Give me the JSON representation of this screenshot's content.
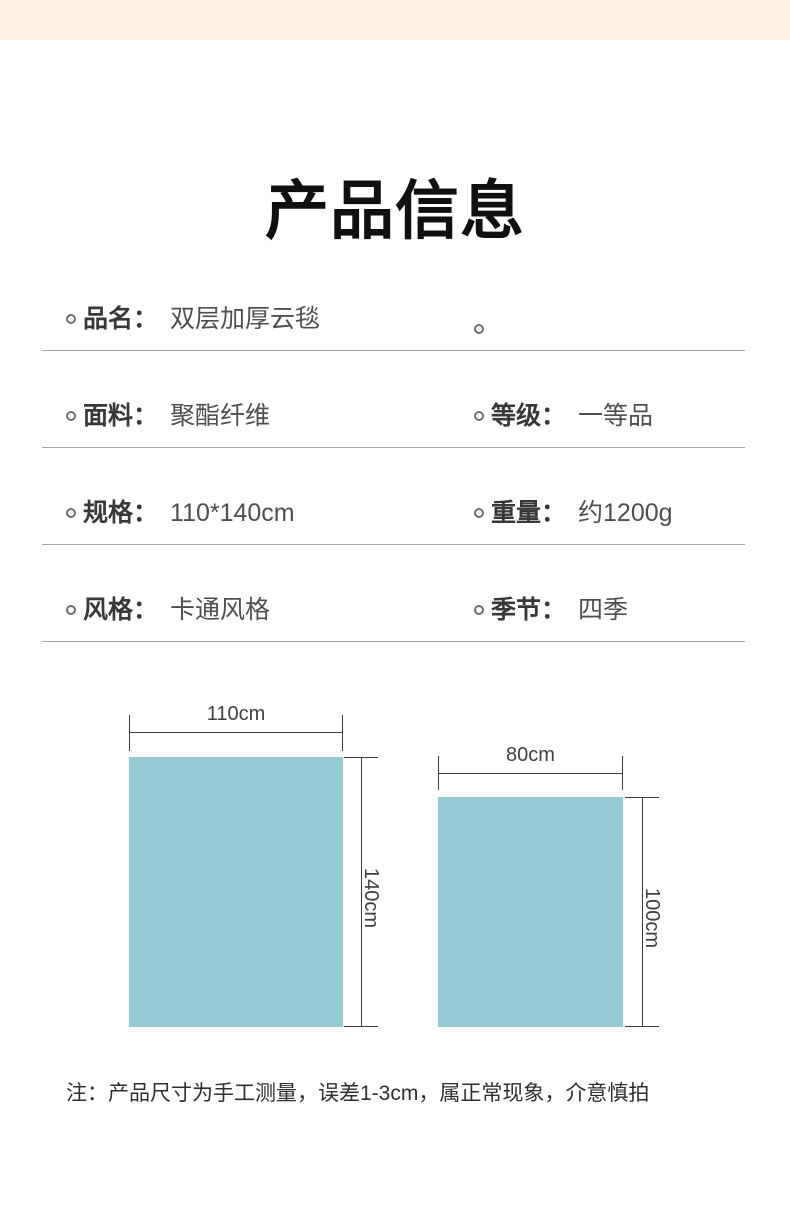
{
  "banner": {
    "color": "#fdf1e4"
  },
  "title": "产品信息",
  "spec_table": {
    "rows": [
      {
        "left": {
          "label": "品名：",
          "value": "双层加厚云毯"
        },
        "right": {
          "label": "",
          "value": ""
        }
      },
      {
        "left": {
          "label": "面料：",
          "value": "聚酯纤维"
        },
        "right": {
          "label": "等级：",
          "value": "一等品"
        }
      },
      {
        "left": {
          "label": "规格：",
          "value": "110*140cm"
        },
        "right": {
          "label": "重量：",
          "value": "约1200g"
        }
      },
      {
        "left": {
          "label": "风格：",
          "value": "卡通风格"
        },
        "right": {
          "label": "季节：",
          "value": "四季"
        }
      }
    ]
  },
  "size_diagram": {
    "fill_color": "#96cbd6",
    "blankets": [
      {
        "width_label": "110cm",
        "height_label": "140cm"
      },
      {
        "width_label": "80cm",
        "height_label": "100cm"
      }
    ]
  },
  "note": "注：产品尺寸为手工测量，误差1-3cm，属正常现象，介意慎拍"
}
